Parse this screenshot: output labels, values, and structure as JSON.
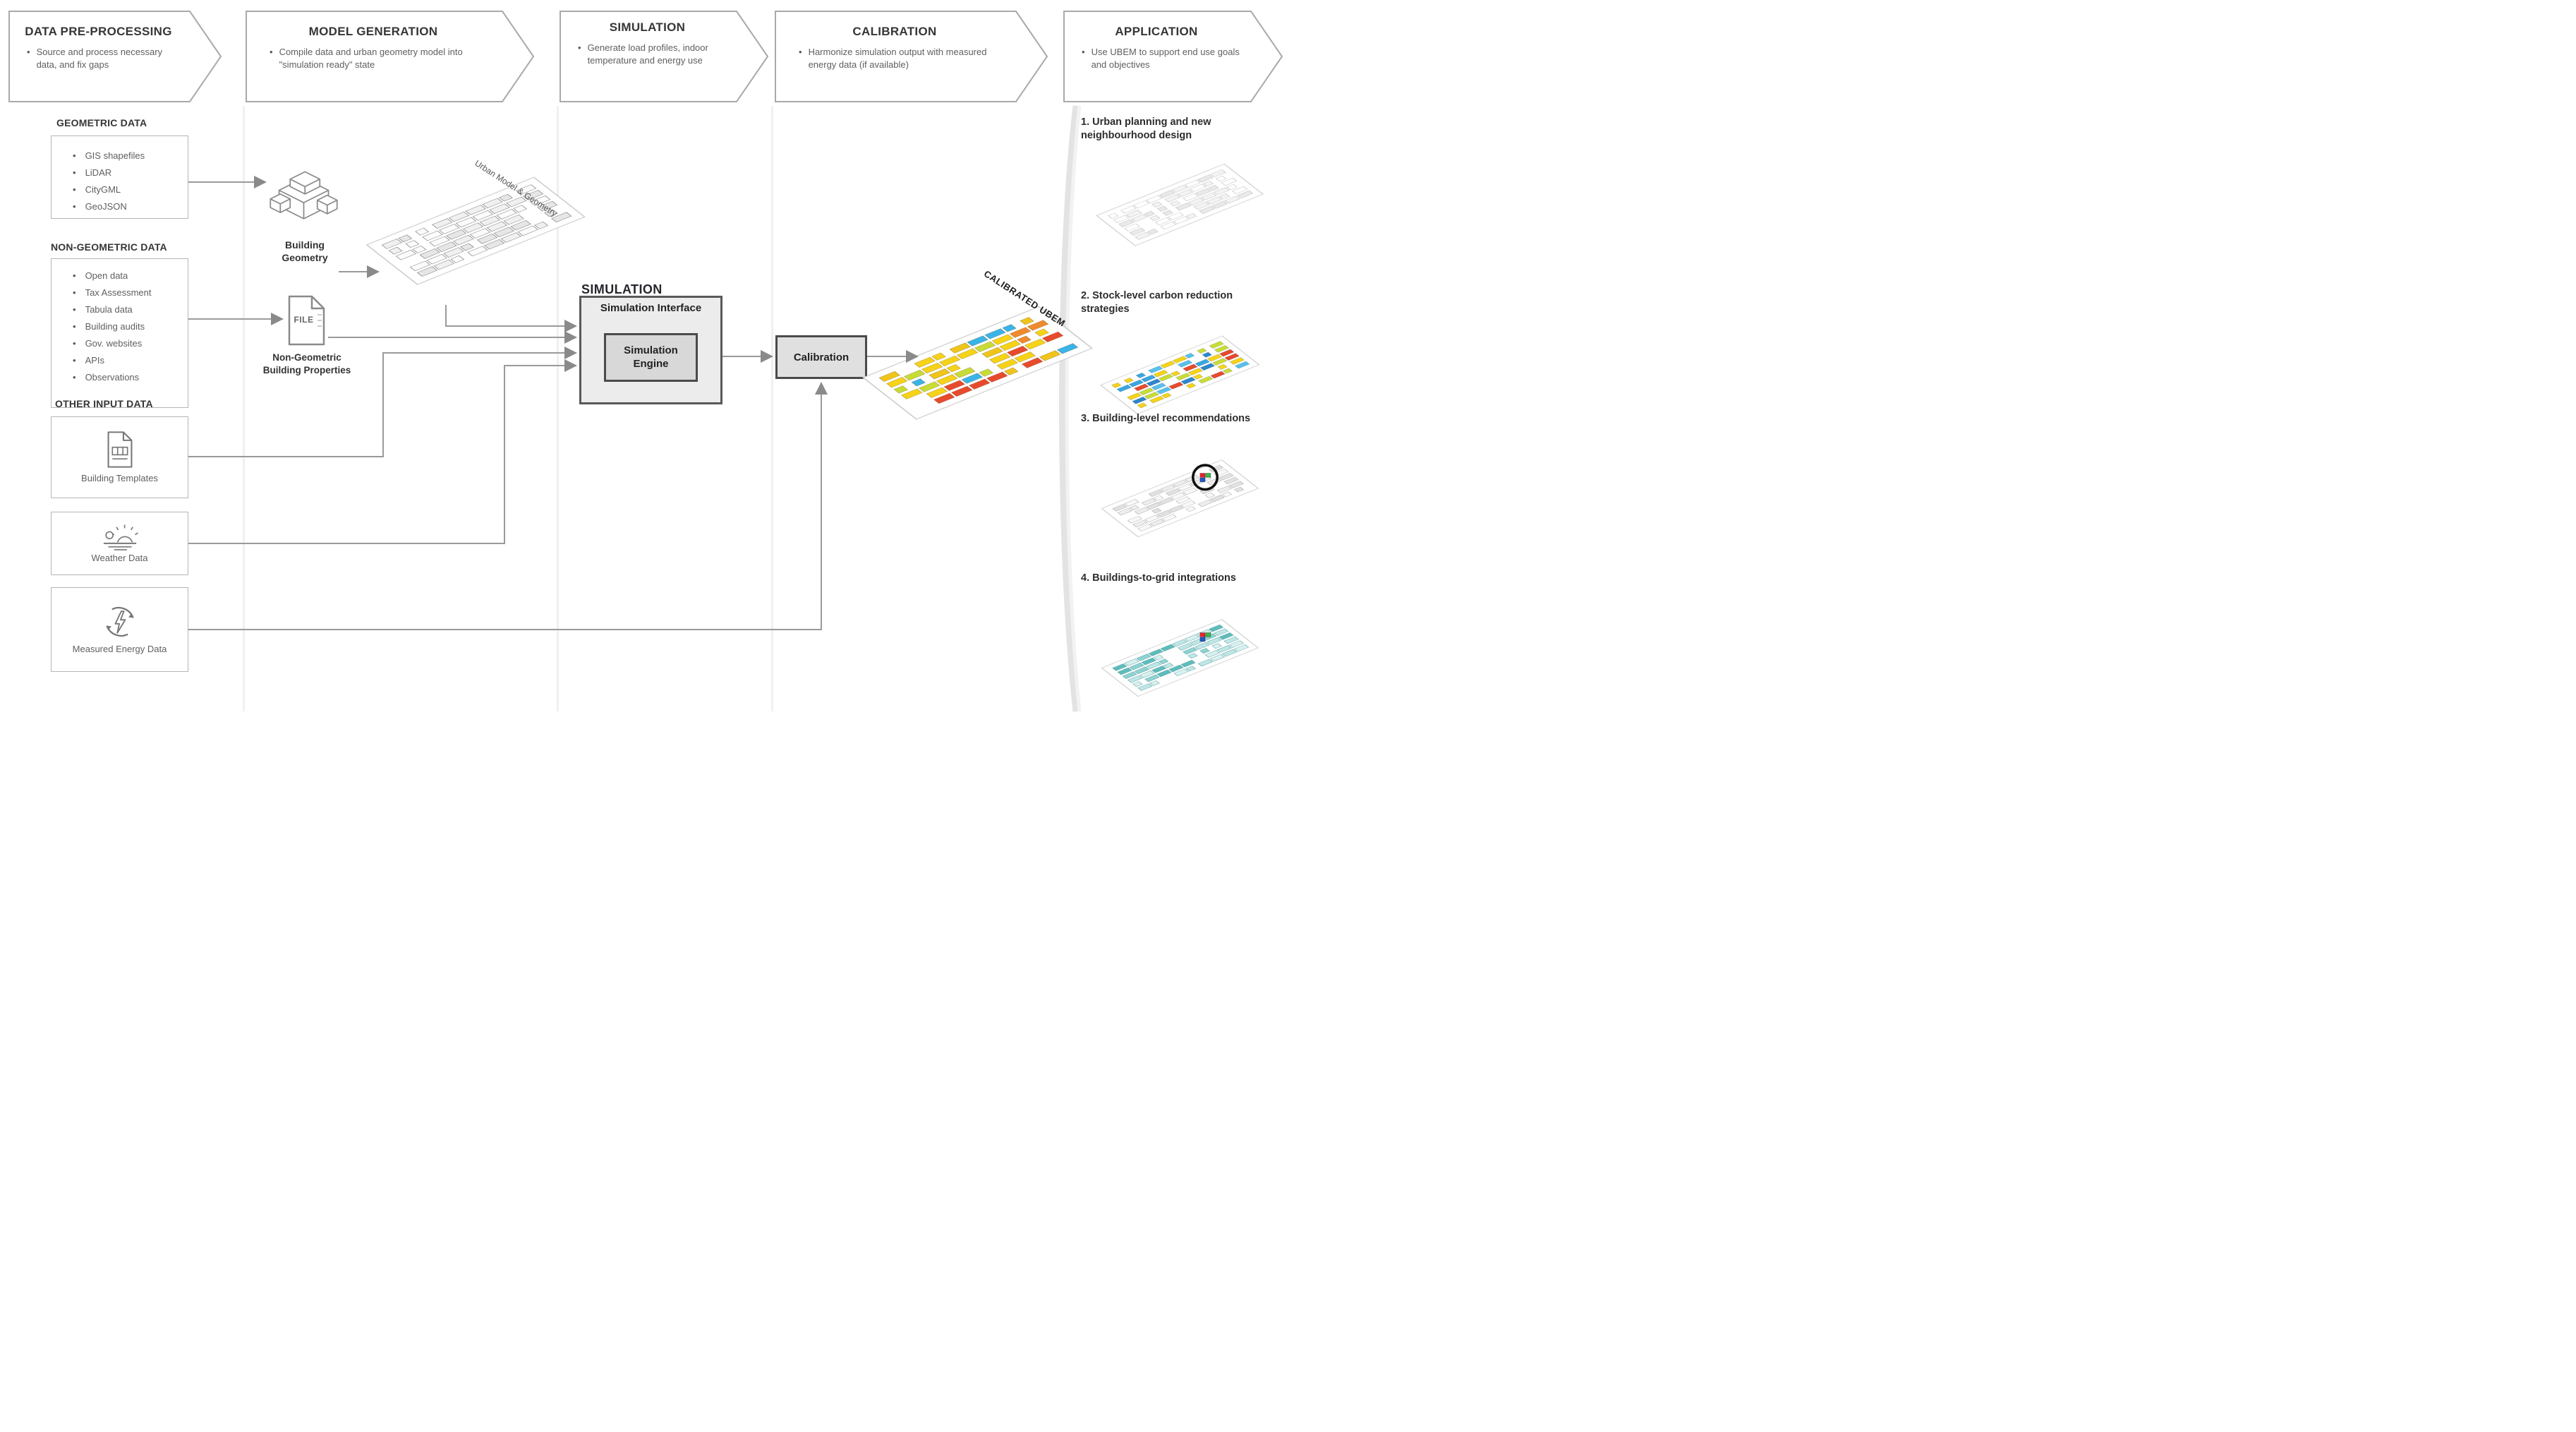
{
  "stages": [
    {
      "title": "DATA PRE-PROCESSING",
      "bullet": "Source and process necessary data, and fix gaps"
    },
    {
      "title": "MODEL GENERATION",
      "bullet": "Compile data and urban geometry model into \"simulation ready\" state"
    },
    {
      "title": "SIMULATION",
      "bullet": "Generate load profiles, indoor temperature and energy use"
    },
    {
      "title": "CALIBRATION",
      "bullet": "Harmonize simulation output with measured energy data (if available)"
    },
    {
      "title": "APPLICATION",
      "bullet": "Use UBEM to support end use goals and objectives"
    }
  ],
  "inputs": {
    "geometric": {
      "heading": "GEOMETRIC DATA",
      "items": [
        "GIS shapefiles",
        "LiDAR",
        "CityGML",
        "GeoJSON"
      ]
    },
    "non_geometric": {
      "heading": "NON-GEOMETRIC DATA",
      "items": [
        "Open data",
        "Tax Assessment",
        "Tabula data",
        "Building audits",
        "Gov. websites",
        "APIs",
        "Observations"
      ]
    },
    "other_heading": "OTHER INPUT DATA",
    "building_templates_label": "Building Templates",
    "weather_label": "Weather Data",
    "measured_energy_label": "Measured Energy Data"
  },
  "model_generation": {
    "building_geometry_label": "Building Geometry",
    "file_icon_label": "FILE",
    "non_geometric_properties_label": "Non-Geometric Building Properties"
  },
  "simulation": {
    "section_label": "SIMULATION",
    "interface_label": "Simulation Interface",
    "engine_label": "Simulation Engine"
  },
  "calibration": {
    "box_label": "Calibration"
  },
  "applications": [
    {
      "label": "1. Urban planning and new neighbourhood design"
    },
    {
      "label": "2. Stock-level carbon reduction strategies"
    },
    {
      "label": "3. Building-level recommendations"
    },
    {
      "label": "4. Buildings-to-grid integrations"
    }
  ],
  "palette": {
    "text_dark": "#363636",
    "text_body": "#5f5f5f",
    "box_border": "#b5b5b5",
    "chevron_border": "#a9a9a9",
    "connector": "#9a9a9a",
    "panel_fill": "#ececec",
    "engine_fill": "#d8d8d8"
  },
  "maps": {
    "urban_model": {
      "label": "Urban Model & Geometry",
      "palette": [
        "#fbfbfb",
        "#f0f0f0",
        "#e6e6e6"
      ],
      "cell_stroke": "#8d8d8d",
      "plate": "#ffffff",
      "seed": 7
    },
    "calibrated": {
      "label": "CALIBRATED UBEM",
      "palette": [
        "#f6d318",
        "#f6d318",
        "#efc51c",
        "#e84a2d",
        "#ef8b2d",
        "#39b4ea",
        "#c9dc35",
        "#f6d318"
      ],
      "cell_stroke": "rgba(90,60,0,0.35)",
      "plate": "#ffffff",
      "seed": 11
    },
    "app_urban_planning": {
      "palette": [
        "#ffffff",
        "#f3f3f3",
        "#e9e9e9"
      ],
      "cell_stroke": "#bdbdbd",
      "plate": "#ffffff",
      "seed": 21
    },
    "app_carbon": {
      "palette": [
        "#f6d318",
        "#3aa7e0",
        "#2f86c9",
        "#c9dc35",
        "#e84a2d",
        "#f6d318",
        "#57c1ea"
      ],
      "cell_stroke": "rgba(0,40,80,0.3)",
      "plate": "#ffffff",
      "seed": 31
    },
    "app_building": {
      "palette": [
        "#f8f8f8",
        "#ededed",
        "#e1e1e1"
      ],
      "cell_stroke": "#aaaaaa",
      "plate": "#ffffff",
      "seed": 41,
      "highlight": [
        "#e8232e",
        "#3bb54a",
        "#2456c5"
      ],
      "circled": true
    },
    "app_grid": {
      "palette": [
        "#bfe6e6",
        "#8fd2d2",
        "#5fbcbc",
        "#d9f0f0"
      ],
      "cell_stroke": "#58a0a0",
      "plate": "#ffffff",
      "seed": 51,
      "highlight": [
        "#e8232e",
        "#3bb54a",
        "#2456c5"
      ]
    }
  }
}
